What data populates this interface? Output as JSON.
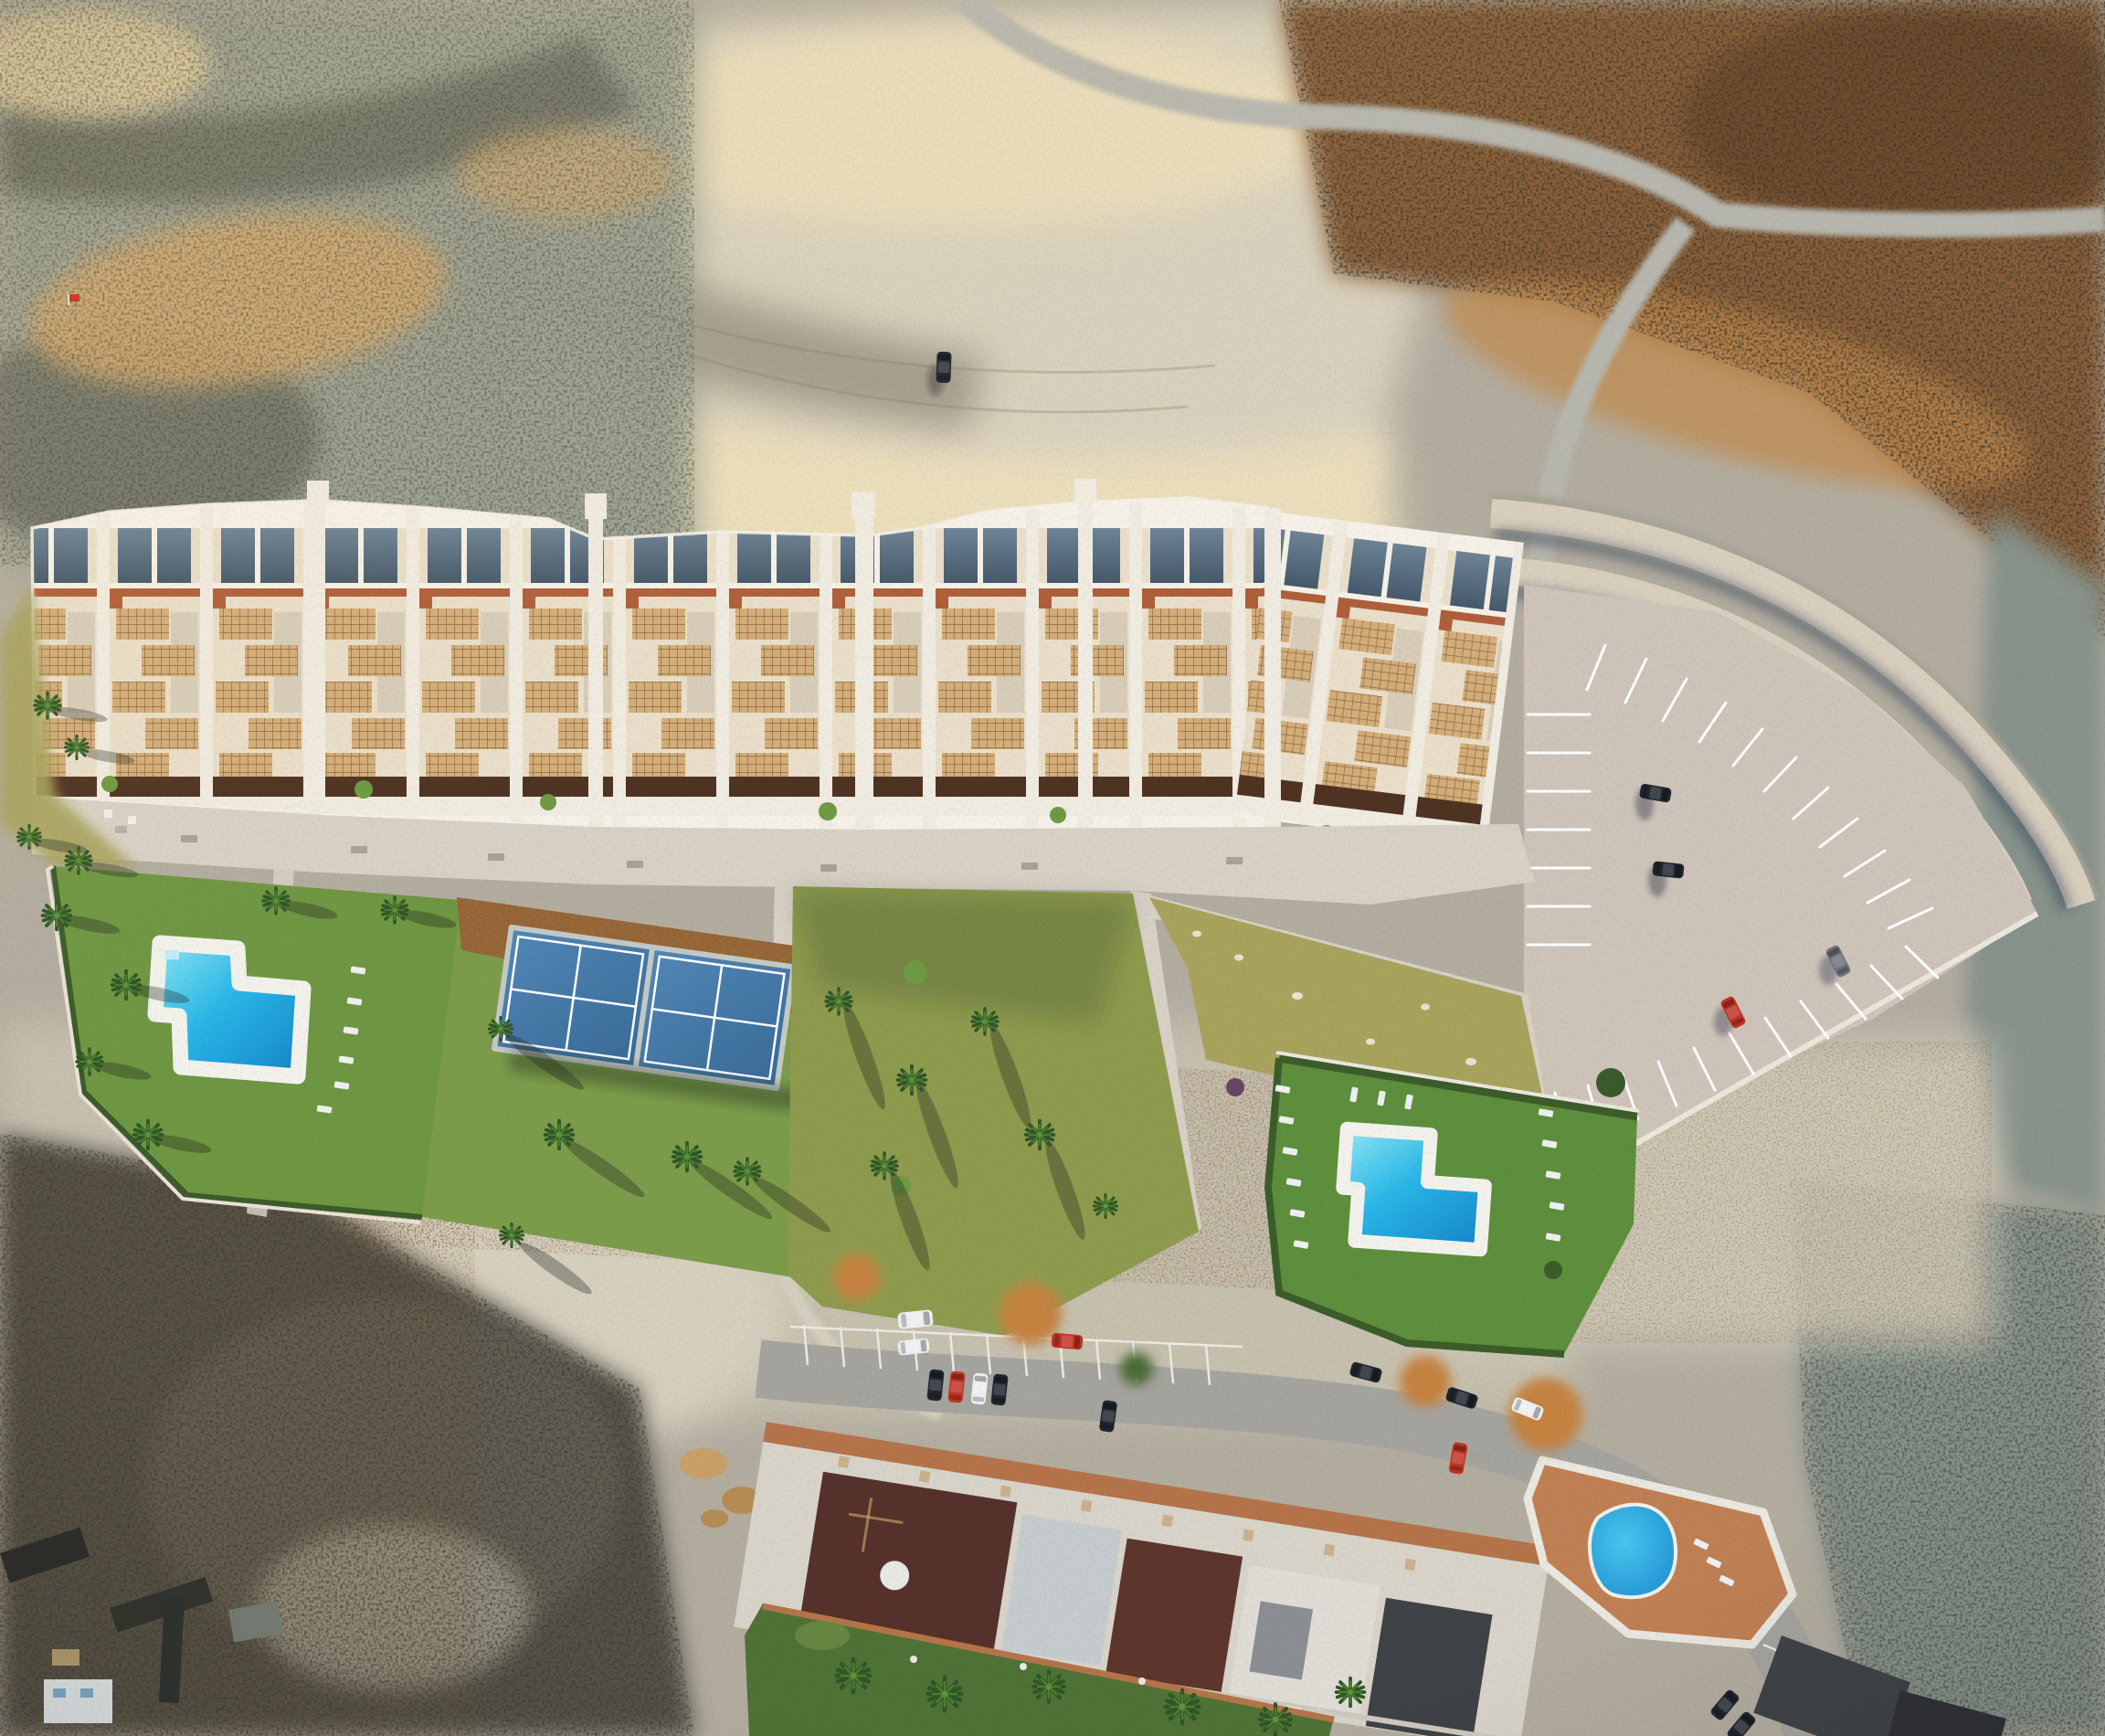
{
  "scene": {
    "type": "aerial-drone-photo-architectural-render",
    "description": "Top-down aerial drone view of an arid badlands hillside. A long new white apartment development (3D render) with terraced pergola roofs and slate skylights sits mid-frame, with a pedestrian promenade, communal lawn gardens, an L-shaped pool on the west, two blue padel courts, a second L-shaped pool on the east, and a fan-striped parking lot behind curved retaining terraces. Below, across a dirt strip, is an existing apartment complex with maroon and white roofs, an access road with parked cars, palm gardens and a free-form blue pool.",
    "visible_text": []
  },
  "labels": {
    "terrain": "Arid badlands terrain",
    "canyon": "Pale eroded canyon floor",
    "scrub_topright": "Brown scrubland",
    "dirt_road": "Dirt road through scrubland",
    "track_car": "Car parked on dirt track",
    "marker_flag": "Red marker flag",
    "new_building": "New white apartment block (render)",
    "promenade": "Pedestrian promenade with benches",
    "bench": "Bench",
    "garden_pool_west": "West communal garden",
    "pool_west": "West L-shaped swimming pool",
    "padel": "Padel courts",
    "garden_central": "Central lawn garden with palms",
    "garden_dry": "Dry lawn parcel with stones",
    "garden_pool_east": "East communal garden",
    "pool_east": "East L-shaped swimming pool",
    "mulch": "Bark mulch bed",
    "parking": "Residents parking lot",
    "retaining": "Curved retaining terraces",
    "parked_car": "Parked car",
    "old_complex": "Existing apartment complex",
    "old_road": "Access road with parked cars",
    "old_pool": "Free-form pool of existing complex",
    "old_garden": "Existing complex garden with palms",
    "palm": "Palm tree",
    "autumn_tree": "Autumn-coloured tree",
    "sheds": "Small sheds and panels",
    "stones": "Boulder cluster",
    "loungers": "Sun loungers"
  },
  "colors": {
    "terrain_base": "#b3ada0",
    "scrub_grey_green": "#9aa193",
    "scrub_dark": "#4f5349",
    "ridge_tan": "#d2a96e",
    "ridge_light": "#e7d3a2",
    "canyon_floor": "#d8d1be",
    "canyon_bright": "#ecdfbd",
    "canyon_shadow": "#6e695c",
    "cliff_edge": "#7d7a6a",
    "scrub_brown": "#8a5f38",
    "scrub_brown_dark": "#57391f",
    "scrub_brown_lit": "#c28a4c",
    "scrub_cool": "#87938b",
    "road_dirt": "#b7b7af",
    "dirt_light": "#c6c0af",
    "dirt_pale": "#d6d0bf",
    "dark_scrub_bl": "#55534a",
    "rocks_tan": "#c8a06a",
    "rocks_tan2": "#b68c56",
    "building_cream": "#eadfca",
    "roof_white": "#f6f2e9",
    "wall_white": "#f1ece1",
    "skylight_a": "#6e8496",
    "skylight_b": "#45596b",
    "terracotta": "#b05f3a",
    "lattice_bg": "#d4ae7a",
    "lattice_line": "#8d6a42",
    "planter": "#4f3322",
    "bush_green": "#6f9a44",
    "promenade": "#d8d1c5",
    "bench_grey": "#aaa294",
    "lawn_bright": "#6f9743",
    "lawn_mid": "#7c9c4b",
    "lawn_olive": "#8e9b4e",
    "lawn_dry": "#a8a45e",
    "lawn_rich": "#5d8f3c",
    "hedge": "#3c5c2a",
    "mulch": "#9a6a3a",
    "pool_rim": "#f3f2ec",
    "pool_light": "#8fe7f4",
    "pool_mid": "#29b7e8",
    "pool_deep": "#1484c8",
    "padel_light": "#5187b6",
    "padel_dark": "#3a6b99",
    "padel_line": "#ffffff",
    "court_frame": "#c3cac6",
    "parking_pavement": "#cfc4ba",
    "stall_line": "#ffffff",
    "terrace_band": "#d9cfbf",
    "terrace_gravel": "#a9a698",
    "terrace_shadow": "rgba(45,60,85,0.45)",
    "asphalt": "#a5a49f",
    "old_walk_terracotta": "#b5744a",
    "old_band": "#d9d4ca",
    "roof_maroon": "#56312b",
    "roof_maroon2": "#5d352c",
    "roof_pale": "#c6ccce",
    "roof_white2": "#e0ddd6",
    "roof_dark": "#3f4246",
    "roof_dark2": "#2f3134",
    "old_lawn": "#4f7236",
    "autumn": "#c5833f",
    "old_pool_light": "#49c6ef",
    "old_pool_deep": "#1b8ed2",
    "pool_deck_terracotta": "#c08054",
    "car_dark": "#20262f",
    "car_red": "#c23325",
    "car_white": "#eef0f2",
    "car_grey": "#6f747a",
    "palm_dark": "#2f5626",
    "palm_light": "#4c7d31",
    "shadow_soft": "rgba(25,32,25,0.32)",
    "building_shadow": "rgba(70,75,70,0.25)",
    "flag_red": "#c82f20"
  },
  "objects": {
    "new_pools": 2,
    "existing_pools": 1,
    "padel_courts": 2,
    "benches": 7,
    "sun_loungers": 23,
    "parked_cars_new_lot": 4,
    "parked_cars_existing_area": 13,
    "car_on_dirt_track": 1,
    "palm_trees": 28
  }
}
